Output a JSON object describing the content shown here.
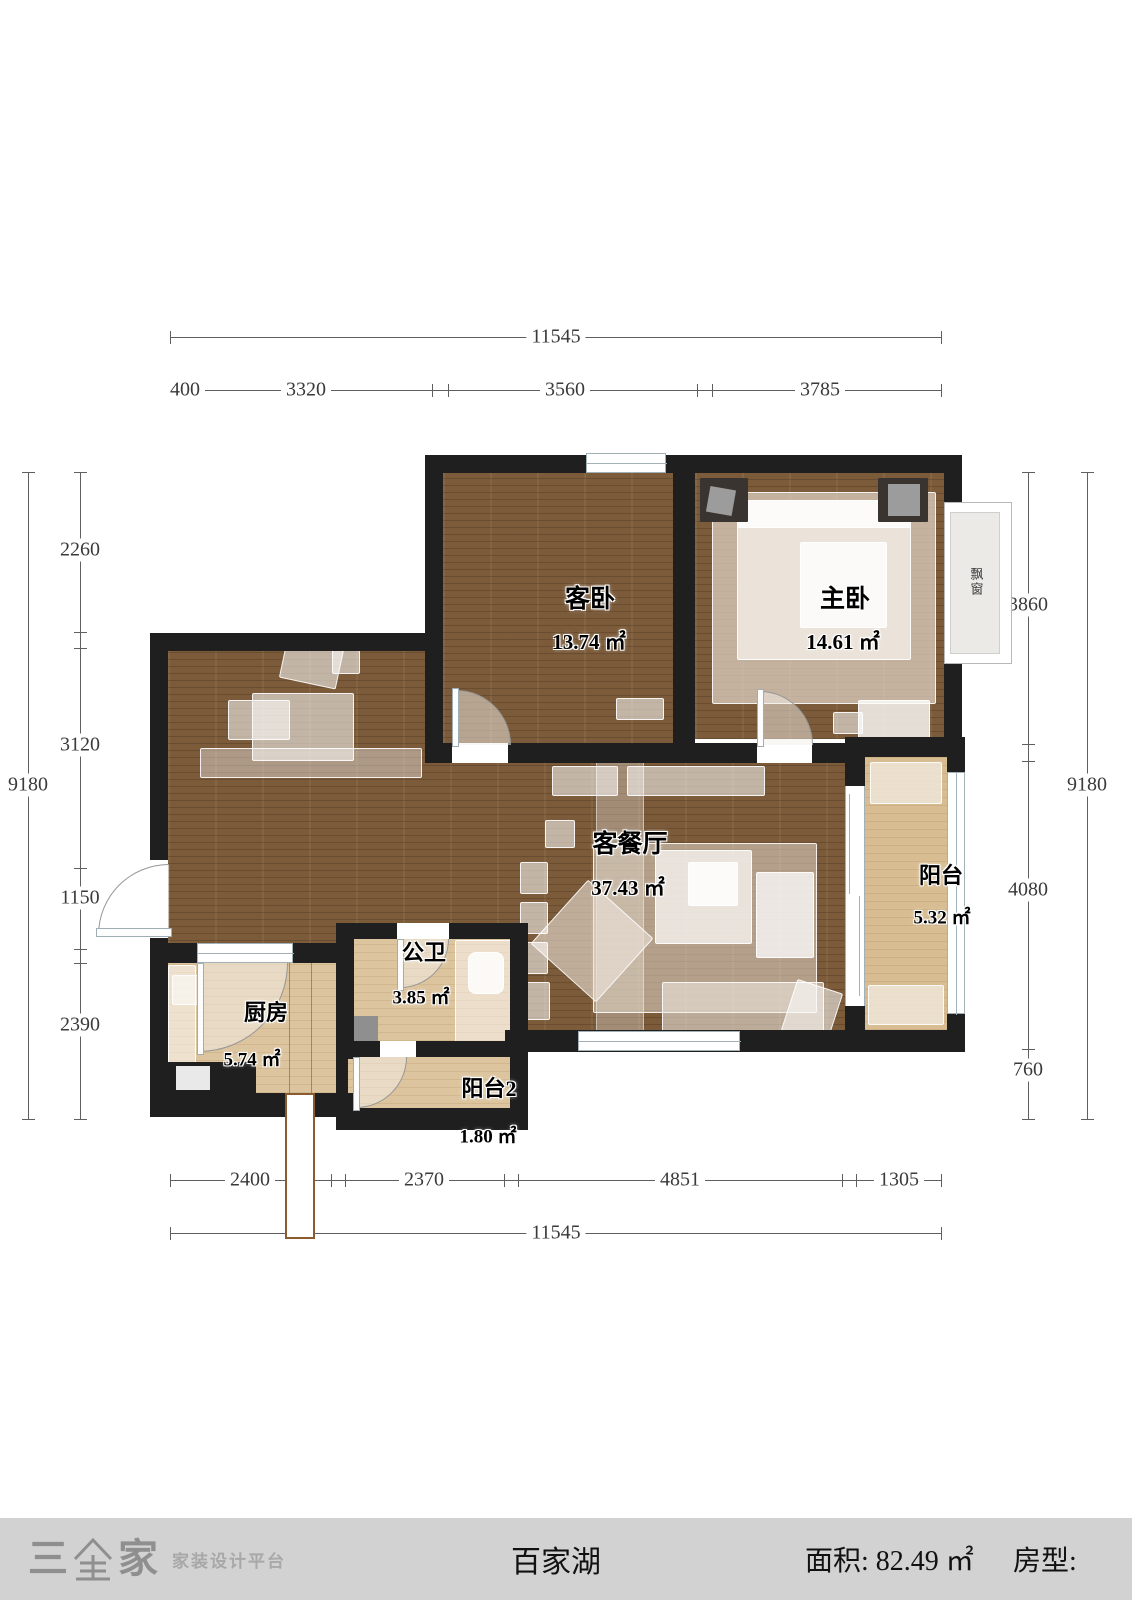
{
  "plan": {
    "rooms": [
      {
        "name": "客卧",
        "area": "13.74 ㎡"
      },
      {
        "name": "主卧",
        "area": "14.61 ㎡"
      },
      {
        "name": "客餐厅",
        "area": "37.43 ㎡"
      },
      {
        "name": "阳台",
        "area": "5.32 ㎡"
      },
      {
        "name": "公卫",
        "area": "3.85 ㎡"
      },
      {
        "name": "厨房",
        "area": "5.74 ㎡"
      },
      {
        "name": "阳台2",
        "area": "1.80 ㎡"
      }
    ],
    "bay_window_label": "飘窗"
  },
  "dims": {
    "top": {
      "overall": "11545",
      "segments": [
        "400",
        "3320",
        "3560",
        "3785"
      ]
    },
    "bottom": {
      "overall": "11545",
      "segments": [
        "2400",
        "2370",
        "4851",
        "1305"
      ]
    },
    "left": {
      "overall": "9180",
      "segments": [
        "2260",
        "3120",
        "1150",
        "2390"
      ]
    },
    "right": {
      "overall": "9180",
      "segments": [
        "3860",
        "4080",
        "760"
      ]
    }
  },
  "footer": {
    "brand_char1": "三",
    "brand_char2": "家",
    "brand_tagline": "家装设计平台",
    "project_name": "百家湖",
    "area_label": "面积:",
    "area_value": "82.49 ㎡",
    "type_label": "房型:"
  },
  "colors": {
    "wall": "#1f1f1f",
    "wood_floor": "#7b5b3a",
    "light_floor": "#dcc49e",
    "footer_bg": "#d2d2d2",
    "dimension_text": "#3a3a3a"
  }
}
